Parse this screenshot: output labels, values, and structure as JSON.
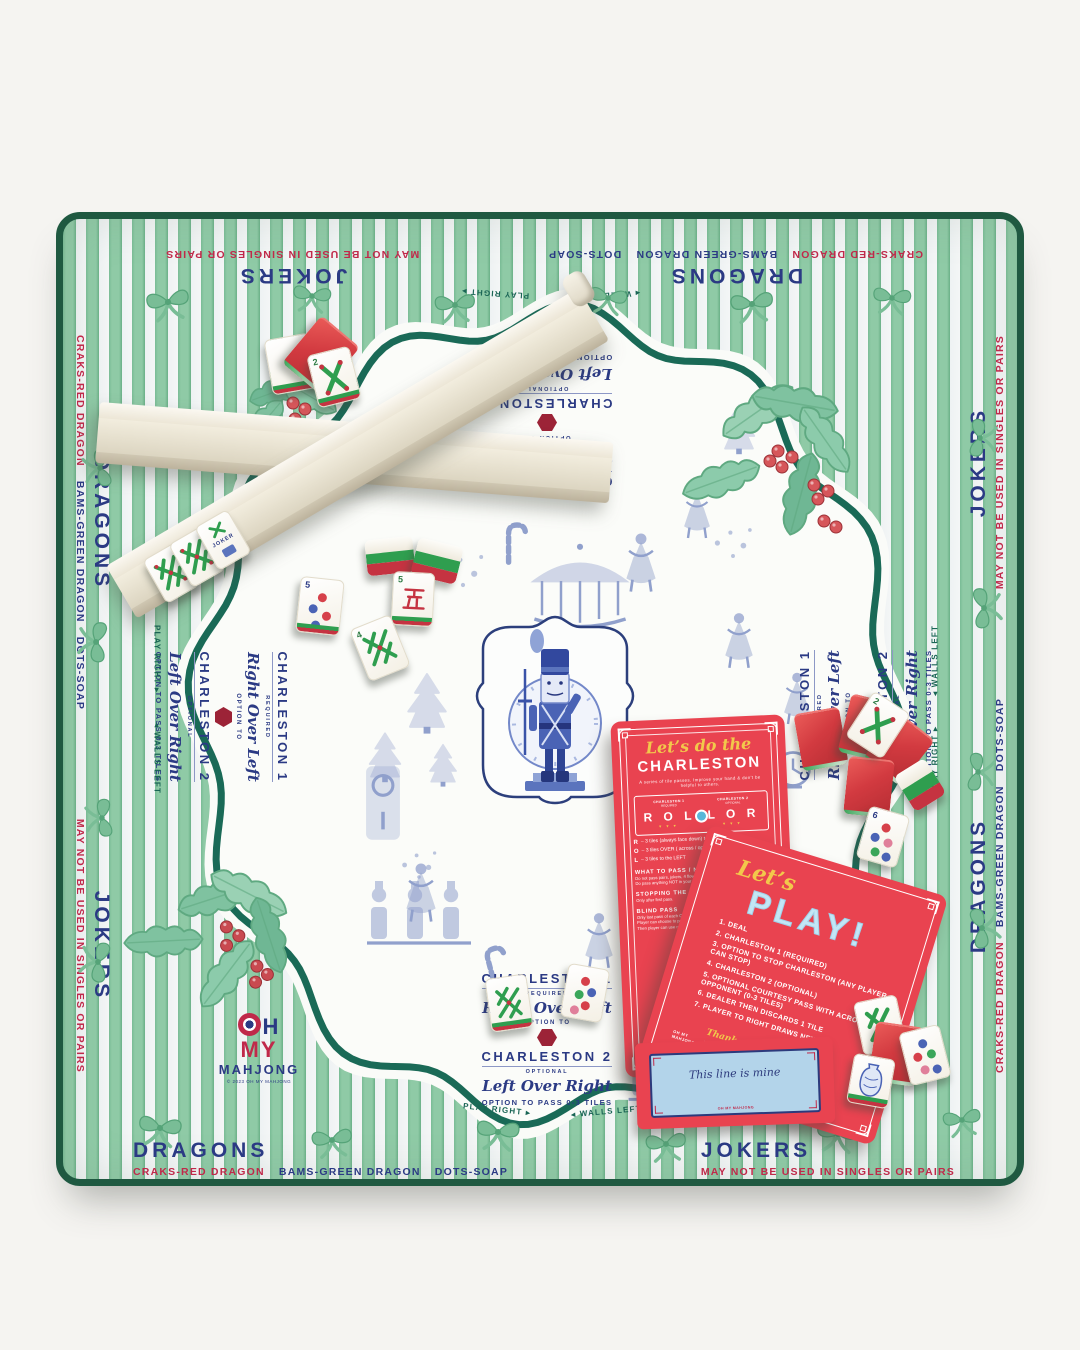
{
  "mat_edges": {
    "jokers": {
      "title": "JOKERS",
      "subtitle": "MAY NOT BE USED IN SINGLES OR PAIRS"
    },
    "dragons": {
      "title": "DRAGONS",
      "craks": "CRAKS-RED DRAGON",
      "bams": "BAMS-GREEN DRAGON",
      "dots": "DOTS-SOAP"
    }
  },
  "directions": {
    "play_right": "PLAY RIGHT ▸",
    "walls_left": "◂ WALLS LEFT"
  },
  "charleston_block": {
    "c1_title": "CHARLESTON 1",
    "c1_tag": "REQUIRED",
    "c1_script": "Right Over Left",
    "option_to": "OPTION TO",
    "c2_title": "CHARLESTON 2",
    "c2_tag": "OPTIONAL",
    "c2_script": "Left Over Right",
    "c2_footer": "OPTION TO PASS 0-3 TILES"
  },
  "logo": {
    "oh_rest": "H",
    "my": "MY",
    "mahjong": "MAHJONG",
    "copyright": "© 2023 OH MY MAHJONG"
  },
  "cards": {
    "charleston": {
      "script": "Let’s do the",
      "title": "CHARLESTON",
      "subtitle": "A series of tile passes. Improve your hand & don’t be helpful to others.",
      "box": {
        "col1": "CHARLESTON 1",
        "col1_tag": "REQUIRED",
        "col1_letters": "R O L",
        "col2": "CHARLESTON 2",
        "col2_tag": "OPTIONAL",
        "col2_letters": "L O R"
      },
      "legend": [
        {
          "k": "R",
          "t": "– 3 tiles (always face down) to the RIGHT"
        },
        {
          "k": "O",
          "t": "– 3 tiles OVER ( across / opposite )"
        },
        {
          "k": "L",
          "t": "– 3 tiles to the LEFT"
        }
      ],
      "what_to_pass": {
        "h": "WHAT TO PASS / NOT PASS",
        "lines": [
          "Do not pass pairs, jokers, 4 flowers, dragons or any tile in your hand.",
          "Do pass anything NOT in your longest & strongest suits."
        ]
      },
      "stopping": {
        "h": "STOPPING THE CHARLESTON",
        "lines": [
          "Only after first pass."
        ]
      },
      "blind": {
        "h": "BLIND PASS",
        "lines": [
          "Only last pass of each Charleston (the 3rd pass).",
          "Player can choose to pass 0-3 unwanted tiles from their hand.",
          "Then player can use remaining tiles, as needed, to complete the pass."
        ]
      }
    },
    "play": {
      "script": "Let’s",
      "title": "PLAY!",
      "steps": [
        "DEAL",
        "CHARLESTON 1 (REQUIRED)",
        "OPTION TO STOP CHARLESTON (ANY PLAYER CAN STOP)",
        "CHARLESTON 2 (OPTIONAL)",
        "OPTIONAL COURTESY PASS WITH ACROSS OPPONENT (0-3 TILES)",
        "DEALER THEN DISCARDS 1 TILE",
        "PLAYER TO RIGHT DRAWS NEXT"
      ],
      "footer_script": "Thank you for",
      "footer_text": "YOU’RE PLAY",
      "logo_small": "OH MY MAHJONG"
    }
  },
  "tag": {
    "message": "This line is mine",
    "logo_small": "OH MY MAHJONG"
  },
  "tiles": {
    "joker_label": "JOKER",
    "crak_num": "5",
    "flower5_num": "5",
    "flower6_num": "6",
    "bam2_num": "2",
    "bam4_num": "4"
  },
  "colors": {
    "stripe_green": "#84c29e",
    "binding_green": "#1f5941",
    "teal_line": "#1a6a57",
    "navy": "#2b3a84",
    "red_text": "#c0294a",
    "card_red": "#e94350",
    "card_yellow": "#f2c84b",
    "card_blue": "#c3e6f5",
    "toile_blue": "#4a63ae",
    "tile_red": "#d23a40",
    "tile_green": "#2f9e4f"
  }
}
